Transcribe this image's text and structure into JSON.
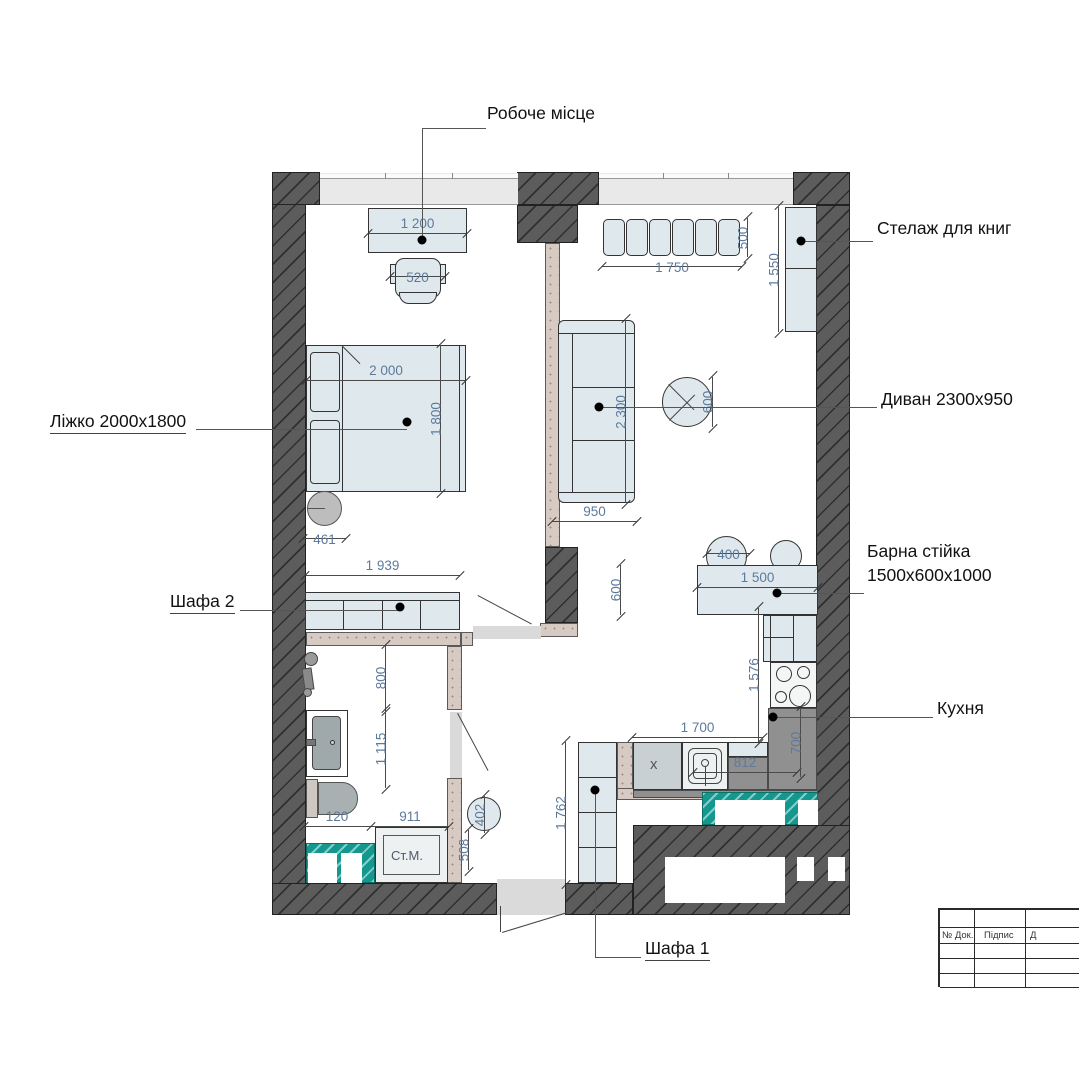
{
  "labels": {
    "workplace": "Робоче місце",
    "bookshelf": "Стелаж для книг",
    "sofa": "Диван 2300х950",
    "bed": "Ліжко 2000х1800",
    "bar_line1": "Барна стійка",
    "bar_line2": "1500х600х1000",
    "kitchen": "Кухня",
    "wardrobe2": "Шафа 2",
    "wardrobe1": "Шафа 1"
  },
  "marks": {
    "washing_machine": "Ст.М.",
    "cabinet_x": "х"
  },
  "dims": {
    "desk": "1 200",
    "chair": "520",
    "bed_len": "2 000",
    "bed_wid": "1 800",
    "side_table": "461",
    "wardrobe2": "1 939",
    "shower": "800",
    "bath": "1 115",
    "toilet_gap": "120",
    "bath_width": "911",
    "hall_depth": "508",
    "hall_table": "402",
    "wardrobe1": "1 762",
    "bench_len": "1 750",
    "bench_dep": "500",
    "bookshelf": "1 550",
    "sofa_len": "2 300",
    "table_dia": "600",
    "sofa_dep": "950",
    "stool": "400",
    "bar_len": "1 500",
    "bar_dep": "600",
    "kitchen_run": "1 576",
    "kitchen_len": "1 700",
    "kitchen_side": "812",
    "kitchen_dep": "700"
  },
  "title_block": {
    "doc": "№ Док.",
    "sign": "Підпис",
    "date": "Д"
  },
  "colors": {
    "wall": "#5c5c5c",
    "partition": "#d7cac3",
    "furniture": "#dfe9ed",
    "tile_teal": "#12988f",
    "counter_gray": "#909090",
    "dim_text": "#5d7a9c",
    "label_text": "#121212"
  }
}
